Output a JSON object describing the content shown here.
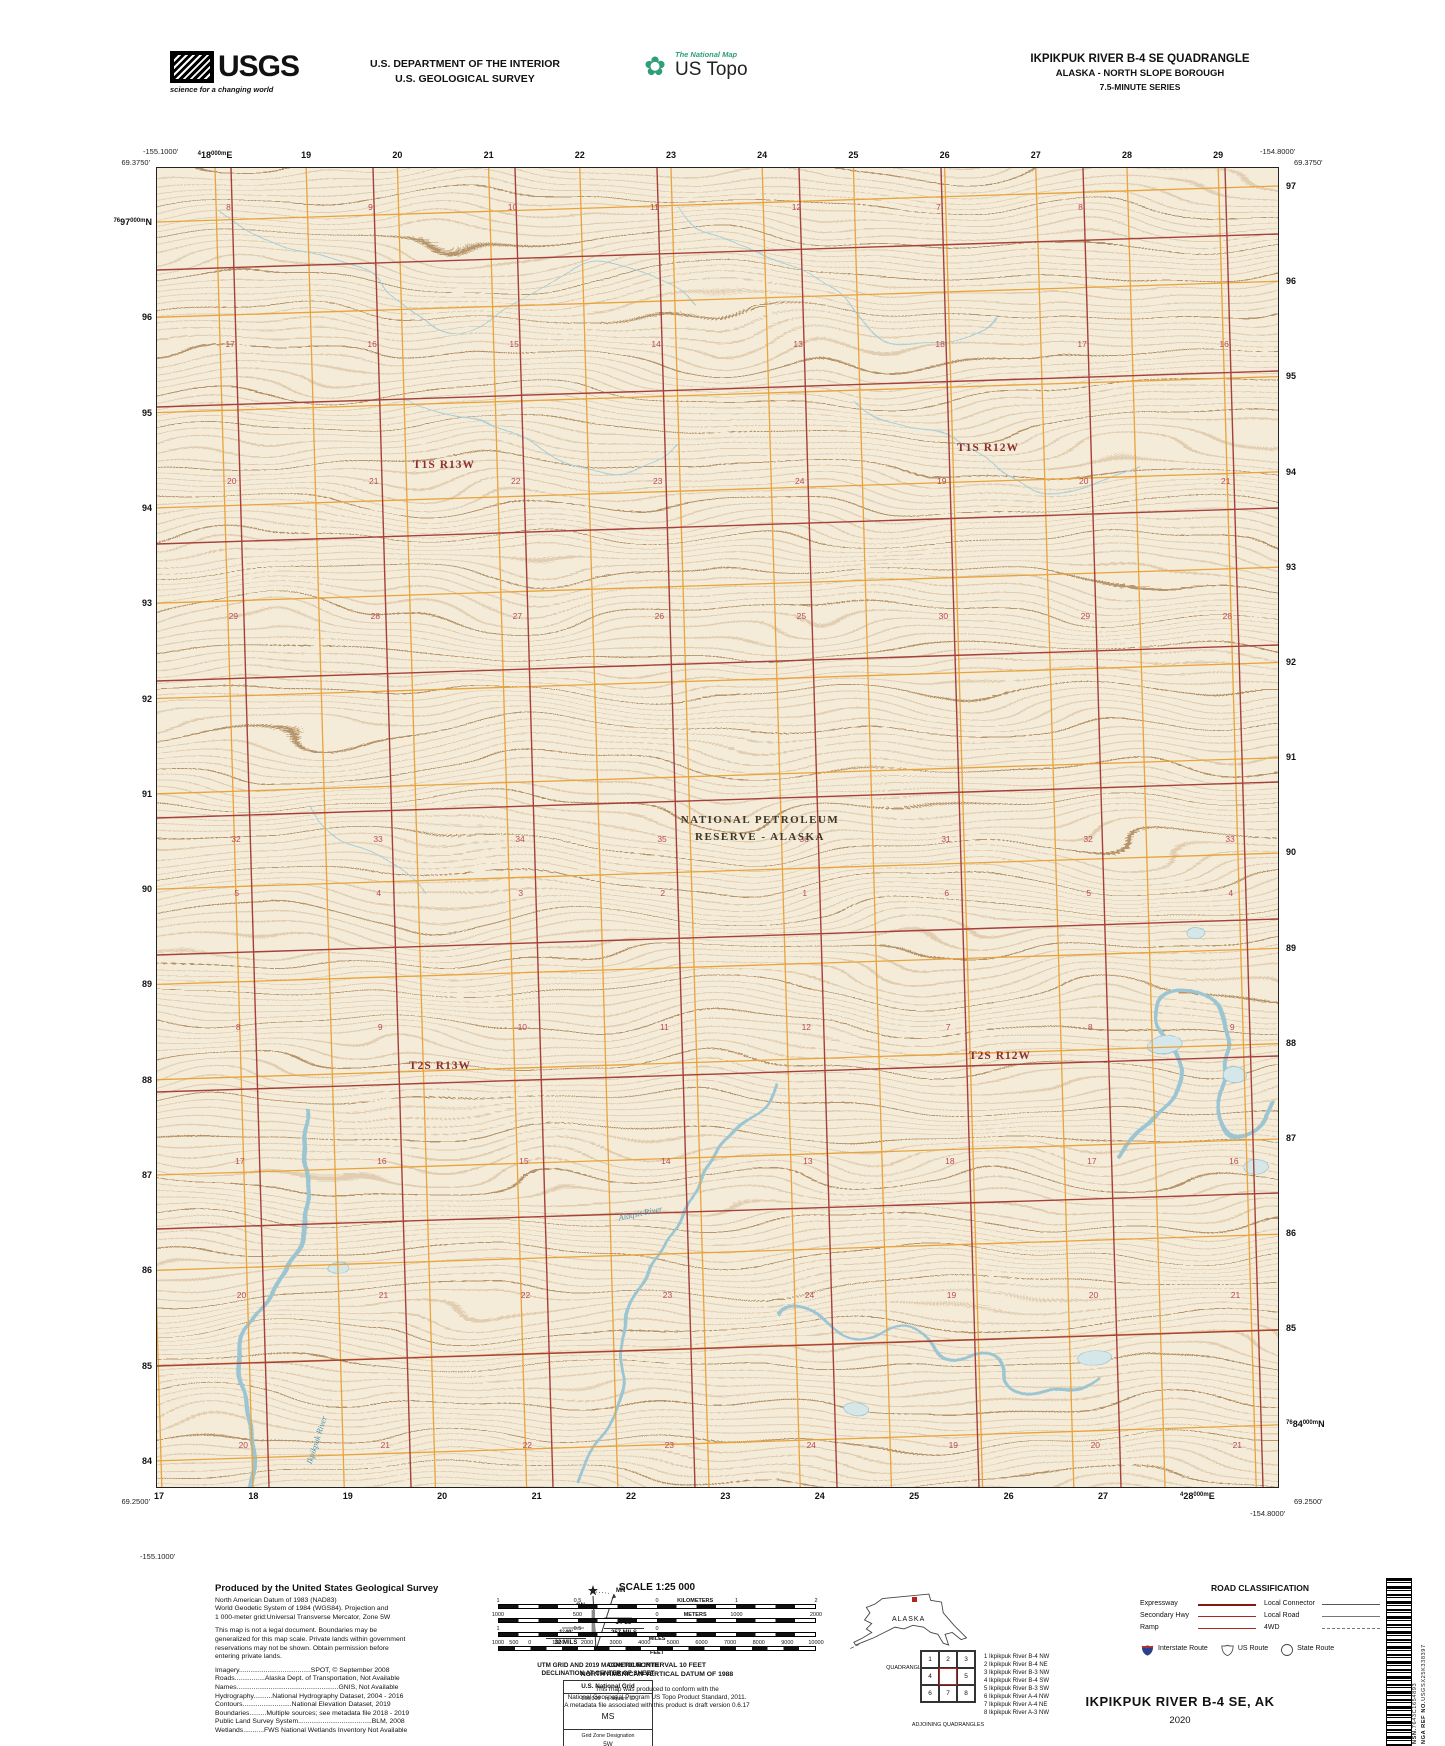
{
  "header": {
    "usgs_logo": "USGS",
    "usgs_tagline": "science for a changing world",
    "dept_line1": "U.S. DEPARTMENT OF THE INTERIOR",
    "dept_line2": "U.S. GEOLOGICAL SURVEY",
    "national_map": "The National Map",
    "us_topo": "US Topo",
    "quad_title": "IKPIKPUK RIVER B-4 SE QUADRANGLE",
    "quad_subtitle": "ALASKA - NORTH SLOPE BOROUGH",
    "quad_series": "7.5-MINUTE SERIES"
  },
  "map": {
    "corners": {
      "top_left_lon": "-155.1000'",
      "top_left_lat": "69.3750'",
      "top_right_lon": "-154.8000'",
      "top_right_lat": "69.3750'",
      "bottom_left_lat": "69.2500'",
      "bottom_left_lon": "-155.1000'",
      "bottom_right_lat": "69.2500'",
      "bottom_right_lon": "-154.8000'"
    },
    "grid": {
      "top": [
        {
          "pre": "4",
          "main": "18",
          "post": "000m",
          "post2": "E"
        },
        "19",
        "20",
        "21",
        "22",
        "23",
        "24",
        "25",
        "26",
        "27",
        "28",
        "29"
      ],
      "bottom": [
        "17",
        "18",
        "19",
        "20",
        "21",
        "22",
        "23",
        "24",
        "25",
        "26",
        "27",
        {
          "pre": "4",
          "main": "28",
          "post": "000m",
          "post2": "E"
        }
      ],
      "left": [
        {
          "pre": "76",
          "main": "97",
          "post": "000m",
          "post2": "N"
        },
        "96",
        "95",
        "94",
        "93",
        "92",
        "91",
        "90",
        "89",
        "88",
        "87",
        "86",
        "85",
        "84"
      ],
      "right": [
        "97",
        "96",
        "95",
        "94",
        "93",
        "92",
        "91",
        "90",
        "89",
        "88",
        "87",
        "86",
        "85",
        {
          "pre": "76",
          "main": "84",
          "post": "000m",
          "post2": "N"
        }
      ]
    },
    "townships": {
      "t1s_r13w": "T1S R13W",
      "t1s_r12w": "T1S R12W",
      "t2s_r13w": "T2S R13W",
      "t2s_r12w": "T2S R12W"
    },
    "reserve_line1": "NATIONAL PETROLEUM",
    "reserve_line2": "RESERVE - ALASKA",
    "rivers": {
      "southwest": "Ikpikpuk River",
      "south_central": "Alaqsit River"
    },
    "sections": {
      "rows": [
        {
          "y": 207,
          "labels": [
            "8",
            "9",
            "10",
            "11",
            "12",
            "7",
            "8"
          ]
        },
        {
          "y": 344,
          "labels": [
            "17",
            "16",
            "15",
            "14",
            "13",
            "18",
            "17",
            "16"
          ]
        },
        {
          "y": 481,
          "labels": [
            "20",
            "21",
            "22",
            "23",
            "24",
            "19",
            "20",
            "21"
          ]
        },
        {
          "y": 616,
          "labels": [
            "29",
            "28",
            "27",
            "26",
            "25",
            "30",
            "29",
            "28"
          ]
        },
        {
          "y": 839,
          "labels": [
            "32",
            "33",
            "34",
            "35",
            "36",
            "31",
            "32",
            "33"
          ]
        },
        {
          "y": 893,
          "labels": [
            "5",
            "4",
            "3",
            "2",
            "1",
            "6",
            "5",
            "4"
          ]
        },
        {
          "y": 1027,
          "labels": [
            "8",
            "9",
            "10",
            "11",
            "12",
            "7",
            "8",
            "9"
          ]
        },
        {
          "y": 1161,
          "labels": [
            "17",
            "16",
            "15",
            "14",
            "13",
            "18",
            "17",
            "16"
          ]
        },
        {
          "y": 1295,
          "labels": [
            "20",
            "21",
            "22",
            "23",
            "24",
            "19",
            "20",
            "21"
          ]
        },
        {
          "y": 1445,
          "labels": [
            "20",
            "21",
            "22",
            "23",
            "24",
            "19",
            "20",
            "21"
          ]
        }
      ]
    }
  },
  "footer": {
    "credits": {
      "title": "Produced by the United States Geological Survey",
      "datum_lines": [
        "North American Datum of 1983 (NAD83)",
        "World Geodetic System of 1984 (WGS84).  Projection and",
        "1 000-meter grid:Universal Transverse Mercator, Zone 5W"
      ],
      "legal_lines": [
        "This map is not a legal document. Boundaries may be",
        "generalized for this map scale. Private lands within government",
        "reservations may not be shown. Obtain permission before",
        "entering private lands."
      ],
      "source_lines": [
        "Imagery......................................SPOT,  ©  September  2008",
        "Roads................Alaska  Dept.  of  Transportation,  Not  Available",
        "Names......................................................GNIS,  Not  Available",
        "Hydrography..........National  Hydrography  Dataset,  2004  -  2016",
        "Contours..........................National  Elevation  Dataset,  2019",
        "Boundaries.........Multiple  sources;  see  metadata  file  2018  -  2019",
        "Public  Land  Survey  System.......................................BLM,  2008",
        "Wetlands...........FWS  National  Wetlands  Inventory  Not  Available"
      ]
    },
    "declination": {
      "gn_label": "GN",
      "mn_label": "MN",
      "gn_value": "1°49'",
      "gn_mils": "32 MILS",
      "mn_value": "14°25'",
      "mn_mils": "257 MILS",
      "caption_line1": "UTM GRID AND 2019 MAGNETIC NORTH",
      "caption_line2": "DECLINATION AT CENTER OF SHEET"
    },
    "usng": {
      "title": "U.S. National Grid",
      "subtitle": "100,000 - m Square ID",
      "square_id": "MS",
      "zone_label": "Grid Zone Designation",
      "zone": "5W"
    },
    "scale": {
      "title": "SCALE 1:25 000",
      "km_labels": [
        "1",
        "0.5",
        "0",
        "1",
        "2"
      ],
      "km_unit": "KILOMETERS",
      "m_labels": [
        "1000",
        "500",
        "0",
        "1000",
        "2000"
      ],
      "m_unit": "METERS",
      "mi_labels": [
        "1",
        "0.5",
        "0"
      ],
      "mi_unit": "MILES",
      "ft_labels": [
        "1000",
        "500",
        "0",
        "1000",
        "2000",
        "3000",
        "4000",
        "5000",
        "6000",
        "7000",
        "8000",
        "9000",
        "10000"
      ],
      "ft_unit": "FEET",
      "contour_line1": "CONTOUR INTERVAL 10 FEET",
      "contour_line2": "NORTH AMERICAN VERTICAL DATUM OF 1988",
      "conform_lines": [
        "This map was produced to conform with the",
        "National Geospatial Program US Topo Product Standard, 2011.",
        "A metadata file associated with this product is draft version 0.6.17"
      ]
    },
    "location": {
      "state_label": "ALASKA",
      "caption": "QUADRANGLE LOCATION"
    },
    "adjoining": {
      "cells": [
        "1",
        "2",
        "3",
        "4",
        "",
        "5",
        "6",
        "7",
        "8"
      ],
      "list": [
        "1 Ikpikpuk River B-4 NW",
        "2 Ikpikpuk River B-4 NE",
        "3 Ikpikpuk River B-3 NW",
        "4 Ikpikpuk River B-4 SW",
        "5 Ikpikpuk River B-3 SW",
        "6 Ikpikpuk River A-4 NW",
        "7 Ikpikpuk River A-4 NE",
        "8 Ikpikpuk River A-3 NW"
      ],
      "caption": "ADJOINING QUADRANGLES"
    },
    "roads": {
      "title": "ROAD CLASSIFICATION",
      "left": [
        {
          "label": "Expressway"
        },
        {
          "label": "Secondary Hwy"
        },
        {
          "label": "Ramp"
        }
      ],
      "right": [
        {
          "label": "Local Connector"
        },
        {
          "label": "Local Road"
        },
        {
          "label": "4WD"
        }
      ],
      "shields": [
        "Interstate Route",
        "US Route",
        "State Route"
      ]
    },
    "title_block": {
      "title": "IKPIKPUK RIVER B-4 SE,  AK",
      "year": "2020"
    },
    "barcode": {
      "nsn_label": "NSN.",
      "nsn": "7643C1654893",
      "nga_label": "NGA REF NO.",
      "nga": "USGSX25K338397"
    }
  },
  "colors": {
    "map_bg": "#f4ecd9",
    "contour": "#c19a6d",
    "contour_index": "#a57a48",
    "grid_orange": "#e8a33d",
    "section_line_red": "#a5403a",
    "water_line": "#a6cdd9",
    "water_fill": "#d6e7ea",
    "section_number": "#b94a56",
    "township_label": "#8e2f2f"
  }
}
